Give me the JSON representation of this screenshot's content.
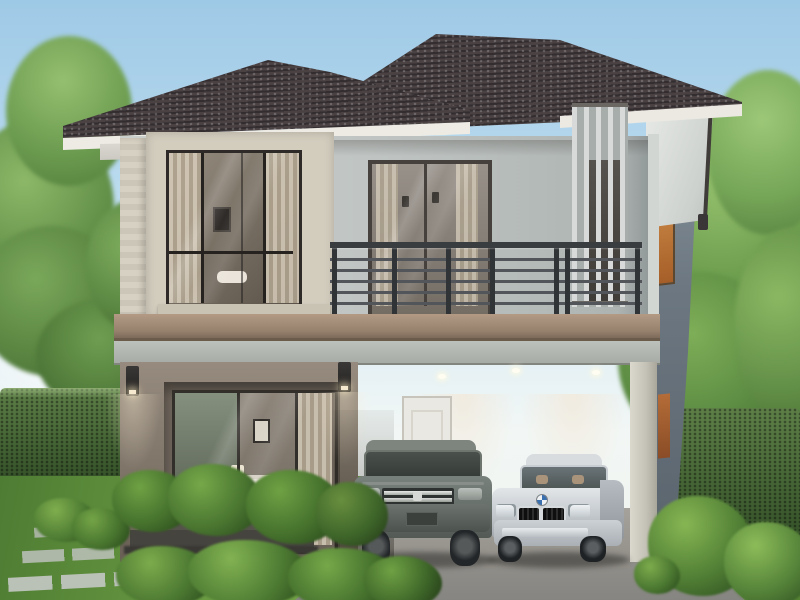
{
  "scene": {
    "type": "architectural-rendering",
    "subject": "modern two-story detached house exterior with carport",
    "time_of_day": "day",
    "elements": [
      "hipped-tile-roof",
      "upper-floor-picture-window",
      "balcony-with-metal-railing",
      "balcony-sliding-door",
      "vertical-louver-screen",
      "side-accent-window",
      "entry-sliding-glass-door",
      "living-room-interior",
      "wall-sconces",
      "carport",
      "carport-white-door",
      "suv-car",
      "sedan-car",
      "hedges",
      "shrubs",
      "lawn",
      "stepping-stone-path",
      "driveway",
      "trees",
      "sky"
    ],
    "palette": {
      "sky_top": "#9ec9e6",
      "sky_horizon": "#eef5f6",
      "roof_tile": "#3d3537",
      "fascia": "#ebe9e2",
      "wall_upper": "#c2c7c5",
      "wall_lower": "#877c70",
      "stone_trim": "#d3cdbe",
      "floor_band": "#a18b79",
      "beam": "#b2b6b1",
      "railing": "#3a3d3f",
      "accent_window": "#c07a3e",
      "foliage_light": "#7fae4e",
      "foliage_dark": "#3c5a2e",
      "grass": "#6d9c44",
      "driveway": "#97968f",
      "suv_body": "#6d7571",
      "sedan_body": "#c8ccd0"
    },
    "vehicle_count": 2
  }
}
